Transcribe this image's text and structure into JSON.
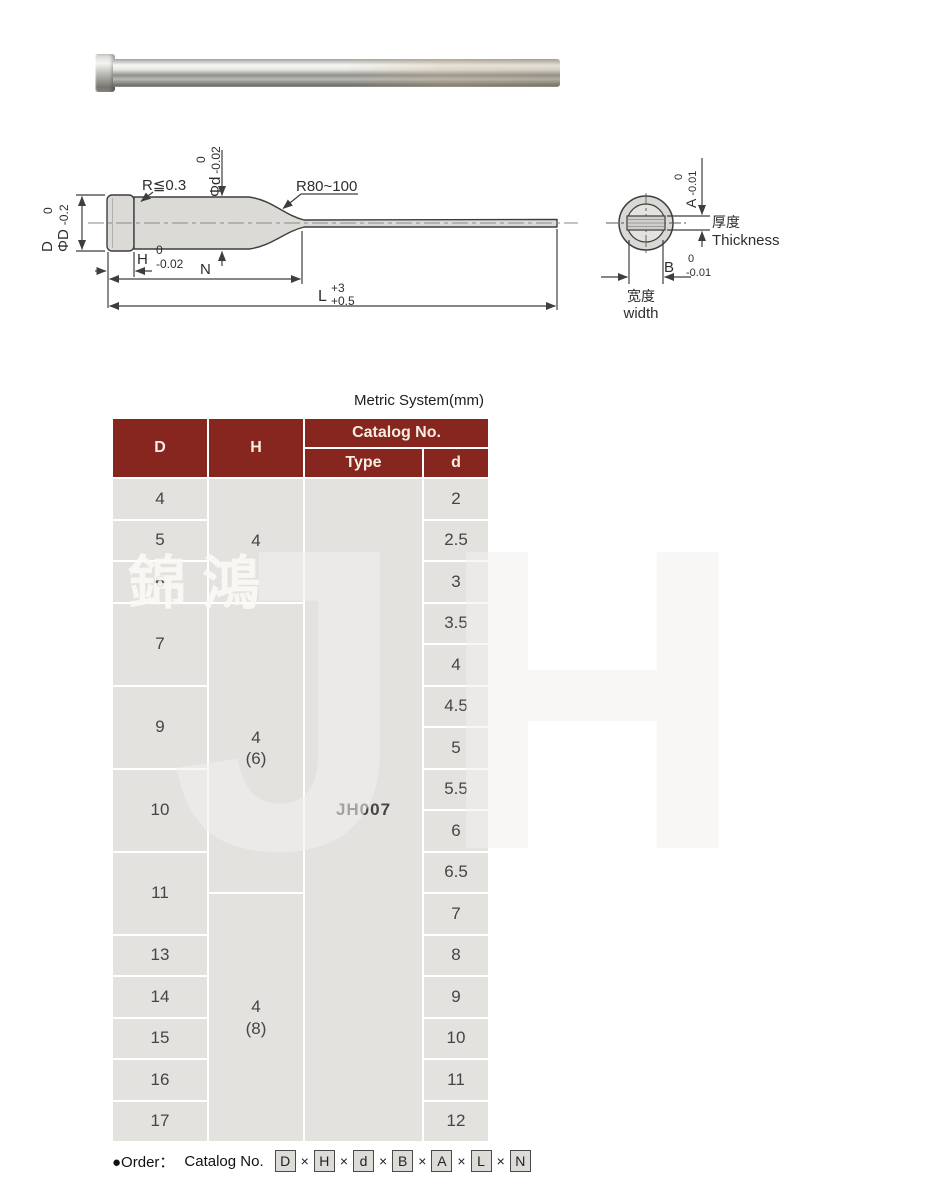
{
  "colors": {
    "header_bg": "#87251f",
    "header_text": "#f5eee2",
    "cell_bg": "#e3e2df",
    "drawing_line": "#3e3e3e"
  },
  "watermark": {
    "logo_text": "JH",
    "company_cn": "錦鴻"
  },
  "drawing": {
    "side_view": {
      "label_r_small": "R≦0.3",
      "label_r_large": "R80~100",
      "dim_D": {
        "name": "D",
        "hi": "0",
        "phi": "ΦD",
        "lo": "-0.2"
      },
      "dim_d": {
        "hi": "0",
        "phi": "Φd",
        "lo": "-0.02"
      },
      "dim_H": {
        "name": "H",
        "hi": "0",
        "lo": "-0.02"
      },
      "dim_N": {
        "name": "N"
      },
      "dim_L": {
        "name": "L",
        "hi": "+3",
        "lo": "+0.5"
      }
    },
    "end_view": {
      "dim_A": {
        "name": "A",
        "hi": "0",
        "lo": "-0.01"
      },
      "dim_B": {
        "name": "B",
        "hi": "0",
        "lo": "-0.01"
      },
      "thickness_cn": "厚度",
      "thickness_en": "Thickness",
      "width_cn": "宽度",
      "width_en": "width"
    }
  },
  "table": {
    "title": "Metric System(mm)",
    "header": {
      "D": "D",
      "H": "H",
      "catalog": "Catalog No.",
      "type": "Type",
      "d": "d"
    },
    "type_value": "JH007",
    "col_D": [
      "4",
      "5",
      "6",
      "7",
      "9",
      "10",
      "11",
      "13",
      "14",
      "15",
      "16",
      "17"
    ],
    "col_H": [
      "4",
      "4\n(6)",
      "4\n(8)"
    ],
    "col_d": [
      "2",
      "2.5",
      "3",
      "3.5",
      "4",
      "4.5",
      "5",
      "5.5",
      "6",
      "6.5",
      "7",
      "8",
      "9",
      "10",
      "11",
      "12"
    ]
  },
  "order": {
    "lead": "●Order：",
    "prefix": "Catalog No.",
    "letters": [
      "D",
      "H",
      "d",
      "B",
      "A",
      "L",
      "N"
    ],
    "separator": "×"
  }
}
